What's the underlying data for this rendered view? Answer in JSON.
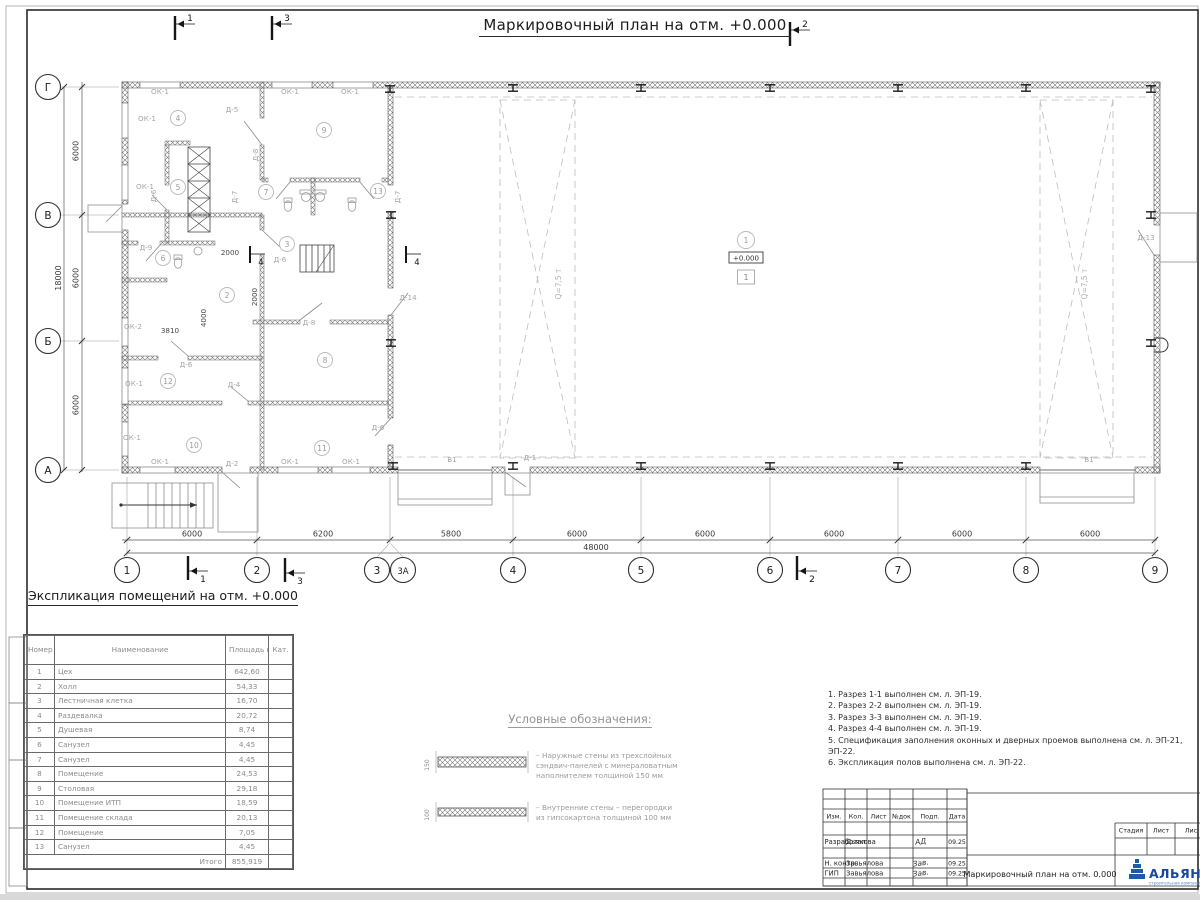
{
  "page": {
    "title": "Маркировочный план на отм. +0.000"
  },
  "plan": {
    "elevation": "+0.000",
    "floor_type": "1",
    "axes_bottom": [
      {
        "n": "1",
        "x": 127
      },
      {
        "n": "2",
        "x": 257
      },
      {
        "n": "3",
        "x": 377
      },
      {
        "n": "3А",
        "x": 403
      },
      {
        "n": "4",
        "x": 513
      },
      {
        "n": "5",
        "x": 641
      },
      {
        "n": "6",
        "x": 770
      },
      {
        "n": "7",
        "x": 898
      },
      {
        "n": "8",
        "x": 1026
      },
      {
        "n": "9",
        "x": 1155
      }
    ],
    "axes_left": [
      {
        "n": "Г",
        "y": 87
      },
      {
        "n": "В",
        "y": 215
      },
      {
        "n": "Б",
        "y": 341
      },
      {
        "n": "А",
        "y": 470
      }
    ],
    "dim_ticks": [
      127,
      257,
      390,
      513,
      641,
      770,
      898,
      1026,
      1155
    ],
    "dims_bottom": [
      {
        "t": "6000",
        "x": 192
      },
      {
        "t": "6200",
        "x": 323
      },
      {
        "t": "5800",
        "x": 451
      },
      {
        "t": "6000",
        "x": 577
      },
      {
        "t": "6000",
        "x": 705
      },
      {
        "t": "6000",
        "x": 834
      },
      {
        "t": "6000",
        "x": 962
      },
      {
        "t": "6000",
        "x": 1090
      }
    ],
    "dim_total_bottom": {
      "t": "48000",
      "x": 596
    },
    "dims_left": [
      {
        "t": "6000",
        "y": 151
      },
      {
        "t": "6000",
        "y": 278
      },
      {
        "t": "6000",
        "y": 405
      }
    ],
    "dim_total_left": {
      "t": "18000",
      "y": 278
    },
    "rooms": [
      {
        "n": "1",
        "x": 746,
        "y": 240
      },
      {
        "n": "2",
        "x": 227,
        "y": 295
      },
      {
        "n": "3",
        "x": 287,
        "y": 244
      },
      {
        "n": "4",
        "x": 178,
        "y": 118
      },
      {
        "n": "5",
        "x": 178,
        "y": 187
      },
      {
        "n": "6",
        "x": 163,
        "y": 258
      },
      {
        "n": "7",
        "x": 266,
        "y": 192
      },
      {
        "n": "8",
        "x": 325,
        "y": 360
      },
      {
        "n": "9",
        "x": 324,
        "y": 130
      },
      {
        "n": "10",
        "x": 194,
        "y": 445
      },
      {
        "n": "11",
        "x": 322,
        "y": 448
      },
      {
        "n": "12",
        "x": 168,
        "y": 381
      },
      {
        "n": "13",
        "x": 378,
        "y": 191
      }
    ],
    "labels": [
      {
        "t": "ОК-1",
        "x": 160,
        "y": 94,
        "c": "d"
      },
      {
        "t": "ОК-1",
        "x": 290,
        "y": 94,
        "c": "d"
      },
      {
        "t": "ОК-1",
        "x": 350,
        "y": 94,
        "c": "d"
      },
      {
        "t": "ОК-1",
        "x": 147,
        "y": 121,
        "c": "d"
      },
      {
        "t": "ОК-1",
        "x": 145,
        "y": 189,
        "c": "d"
      },
      {
        "t": "ОК-2",
        "x": 133,
        "y": 329,
        "c": "d"
      },
      {
        "t": "ОК-1",
        "x": 134,
        "y": 386,
        "c": "d"
      },
      {
        "t": "ОК-1",
        "x": 132,
        "y": 440,
        "c": "d"
      },
      {
        "t": "ОК-1",
        "x": 160,
        "y": 464,
        "c": "d"
      },
      {
        "t": "ОК-1",
        "x": 290,
        "y": 464,
        "c": "d"
      },
      {
        "t": "ОК-1",
        "x": 351,
        "y": 464,
        "c": "d"
      },
      {
        "t": "Д-5",
        "x": 232,
        "y": 112,
        "c": "d"
      },
      {
        "t": "Д-8",
        "x": 258,
        "y": 155,
        "c": "d",
        "r": -90
      },
      {
        "t": "Д-6",
        "x": 156,
        "y": 196,
        "c": "d",
        "r": -90
      },
      {
        "t": "Д-7",
        "x": 237,
        "y": 197,
        "c": "d",
        "r": -90
      },
      {
        "t": "Д-7",
        "x": 400,
        "y": 197,
        "c": "d",
        "r": -90
      },
      {
        "t": "Д-9",
        "x": 146,
        "y": 250,
        "c": "d"
      },
      {
        "t": "Д-6",
        "x": 280,
        "y": 262,
        "c": "d"
      },
      {
        "t": "Д-8",
        "x": 309,
        "y": 325,
        "c": "d"
      },
      {
        "t": "Д-6",
        "x": 186,
        "y": 367,
        "c": "d"
      },
      {
        "t": "Д-4",
        "x": 234,
        "y": 387,
        "c": "d"
      },
      {
        "t": "Д-6",
        "x": 378,
        "y": 430,
        "c": "d"
      },
      {
        "t": "Д-2",
        "x": 232,
        "y": 466,
        "c": "d"
      },
      {
        "t": "Д-1",
        "x": 530,
        "y": 460,
        "c": "d"
      },
      {
        "t": "Д-14",
        "x": 408,
        "y": 300,
        "c": "d"
      },
      {
        "t": "Д-13",
        "x": 1146,
        "y": 240,
        "c": "d"
      },
      {
        "t": "В1",
        "x": 452,
        "y": 462,
        "c": "d"
      },
      {
        "t": "В1",
        "x": 1089,
        "y": 462,
        "c": "d"
      },
      {
        "t": "2000",
        "x": 230,
        "y": 255,
        "c": "m"
      },
      {
        "t": "2000",
        "x": 257,
        "y": 297,
        "c": "m",
        "r": -90
      },
      {
        "t": "4000",
        "x": 206,
        "y": 318,
        "c": "m",
        "r": -90
      },
      {
        "t": "3810",
        "x": 170,
        "y": 333,
        "c": "m"
      },
      {
        "t": "Q=7,5 т",
        "x": 561,
        "y": 284,
        "c": "q",
        "r": -90
      },
      {
        "t": "Q=7,5 т",
        "x": 1087,
        "y": 284,
        "c": "q",
        "r": -90
      }
    ],
    "columns": [
      [
        390,
        89
      ],
      [
        513,
        88
      ],
      [
        641,
        88
      ],
      [
        770,
        88
      ],
      [
        898,
        88
      ],
      [
        1026,
        88
      ],
      [
        393,
        466
      ],
      [
        513,
        466
      ],
      [
        641,
        466
      ],
      [
        770,
        466
      ],
      [
        898,
        466
      ],
      [
        1026,
        466
      ],
      [
        1151,
        89
      ],
      [
        1151,
        215
      ],
      [
        1151,
        343
      ],
      [
        391,
        215
      ],
      [
        391,
        343
      ]
    ],
    "flags": [
      {
        "n": "1",
        "x": 175,
        "y": 16,
        "v": "t"
      },
      {
        "n": "3",
        "x": 272,
        "y": 16,
        "v": "t"
      },
      {
        "n": "2",
        "x": 790,
        "y": 22,
        "v": "t"
      },
      {
        "n": "1",
        "x": 188,
        "y": 556,
        "v": "b"
      },
      {
        "n": "3",
        "x": 285,
        "y": 558,
        "v": "b"
      },
      {
        "n": "2",
        "x": 797,
        "y": 556,
        "v": "b"
      },
      {
        "n": "4",
        "x": 250,
        "y": 246,
        "v": "m"
      },
      {
        "n": "4",
        "x": 406,
        "y": 246,
        "v": "m"
      }
    ]
  },
  "exp": {
    "heading": "Экспликация помещений на отм. +0.000",
    "headers": [
      "Номер пом.",
      "Наименование",
      "Площадь кв.м",
      "Кат."
    ],
    "rows": [
      [
        "1",
        "Цех",
        "642,60"
      ],
      [
        "2",
        "Холл",
        "54,33"
      ],
      [
        "3",
        "Лестничная клетка",
        "16,70"
      ],
      [
        "4",
        "Раздевалка",
        "20,72"
      ],
      [
        "5",
        "Душевая",
        "8,74"
      ],
      [
        "6",
        "Санузел",
        "4,45"
      ],
      [
        "7",
        "Санузел",
        "4,45"
      ],
      [
        "8",
        "Помещение",
        "24,53"
      ],
      [
        "9",
        "Столовая",
        "29,18"
      ],
      [
        "10",
        "Помещение ИТП",
        "18,59"
      ],
      [
        "11",
        "Помещение склада",
        "20,13"
      ],
      [
        "12",
        "Помещение",
        "7,05"
      ],
      [
        "13",
        "Санузел",
        "4,45"
      ]
    ],
    "total_label": "Итого",
    "total": "855,919"
  },
  "legend": {
    "heading": "Условные обозначения:",
    "items": [
      {
        "dim": "150",
        "lines": [
          "– Наружные стены из трехслойных",
          "сэндвич-панелей с минераловатным",
          "наполнителем толщиной 150 мм"
        ]
      },
      {
        "dim": "100",
        "lines": [
          "– Внутренние стены – перегородки",
          "из гипсокартона толщиной 100 мм"
        ]
      }
    ]
  },
  "notes": [
    "1. Разрез 1-1 выполнен см. л. ЭП-19.",
    "2. Разрез 2-2 выполнен см. л. ЭП-19.",
    "3. Разрез 3-3 выполнен см. л. ЭП-19.",
    "4. Разрез 4-4 выполнен см. л. ЭП-19.",
    "5. Спецификация заполнения оконных и дверных проемов выполнена см. л. ЭП-21, ЭП-22.",
    "6. Экспликация полов выполнена см. л. ЭП-22."
  ],
  "stamp": {
    "cols": [
      "Изм.",
      "Кол.",
      "Лист",
      "№док",
      "Подп.",
      "Дата"
    ],
    "rows": [
      {
        "role": "Разработал",
        "name": "Дьякова",
        "sig": "АД",
        "date": "09.25"
      },
      {
        "role": "Н. контр.",
        "name": "Завьялова",
        "sig": "Зав.",
        "date": "09.25"
      },
      {
        "role": "ГИП",
        "name": "Завьялова",
        "sig": "Зав.",
        "date": "09.25"
      }
    ],
    "title": "Маркировочный план на отм. 0.000",
    "right_headers": [
      "Стадия",
      "Лист",
      "Лис"
    ],
    "logo": "АЛЬЯНС",
    "logo_sub": "строительная компания",
    "logo_color": "#1c4f9e"
  }
}
